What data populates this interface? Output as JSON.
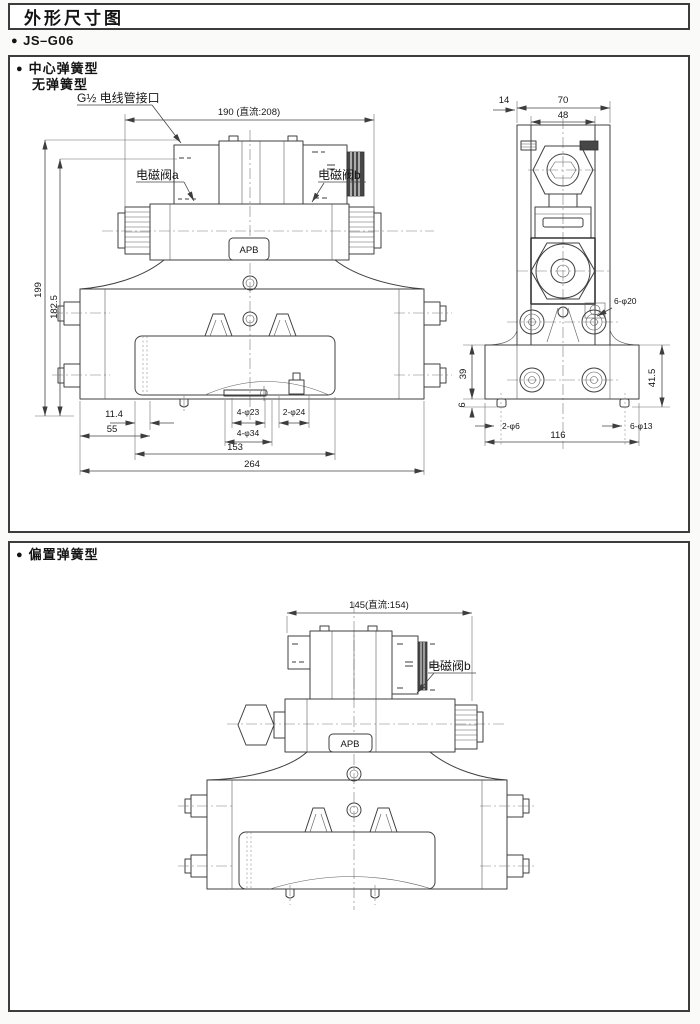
{
  "page": {
    "title": "外形尺寸图",
    "model_bullet": "●",
    "model": "JS–G06"
  },
  "section1": {
    "bullet": "●",
    "label_line1": "中心弹簧型",
    "label_line2": "无弹簧型",
    "front": {
      "conduit_label": "G½ 电线管接口",
      "solenoid_a": "电磁阀a",
      "solenoid_b": "电磁阀b",
      "nameplate": "APB",
      "dim_width": "190 (直流:208)",
      "dim_h1": "199",
      "dim_h2": "182.5",
      "dim_11_4": "11.4",
      "dim_55": "55",
      "dim_153": "153",
      "dim_264": "264",
      "holes_4_23": "4-φ23",
      "holes_2_24": "2-φ24",
      "holes_4_34": "4-φ34"
    },
    "side": {
      "dim_70": "70",
      "dim_48": "48",
      "dim_14": "14",
      "holes_6_20": "6-φ20",
      "dim_39": "39",
      "dim_41_5": "41.5",
      "dim_6": "6",
      "holes_2_6": "2-φ6",
      "dim_116": "116",
      "holes_6_13": "6-φ13"
    }
  },
  "section2": {
    "bullet": "●",
    "label": "偏置弹簧型",
    "dim_width": "145(直流:154)",
    "solenoid_b": "电磁阀b",
    "nameplate": "APB"
  }
}
